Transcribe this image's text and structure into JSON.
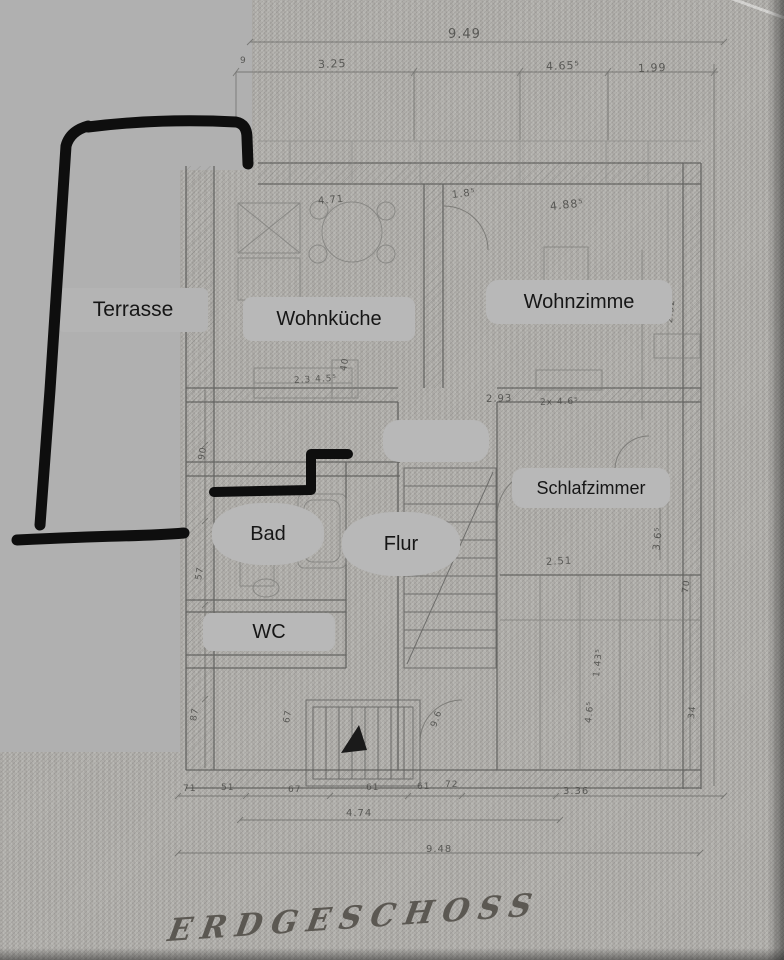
{
  "title": {
    "text": "ERDGESCHOSS"
  },
  "rooms": [
    {
      "id": "terrasse",
      "label": "Terrasse"
    },
    {
      "id": "wohnkueche",
      "label": "Wohnküche"
    },
    {
      "id": "wohnzimmer",
      "label": "Wohnzimme"
    },
    {
      "id": "schlafzimmer",
      "label": "Schlafzimmer"
    },
    {
      "id": "bad",
      "label": "Bad"
    },
    {
      "id": "flur",
      "label": "Flur"
    },
    {
      "id": "wc",
      "label": "WC"
    },
    {
      "id": "blank",
      "label": ""
    }
  ],
  "dimensions": {
    "total_width_top": "9.49",
    "total_width_bottom": "9.48",
    "top_segments": [
      "3.25",
      "4.65⁵",
      "1.99"
    ],
    "annotations": [
      {
        "text": "9.49",
        "x": 448,
        "y": 27,
        "rot": 0,
        "size": 13
      },
      {
        "text": "9",
        "x": 240,
        "y": 56,
        "rot": 0,
        "size": 9
      },
      {
        "text": "3.25",
        "x": 318,
        "y": 58,
        "rot": -2,
        "size": 11
      },
      {
        "text": "4.65⁵",
        "x": 546,
        "y": 60,
        "rot": -2,
        "size": 11
      },
      {
        "text": "1.99",
        "x": 638,
        "y": 62,
        "rot": -2,
        "size": 11
      },
      {
        "text": "4.71",
        "x": 318,
        "y": 196,
        "rot": -5,
        "size": 10
      },
      {
        "text": "1.8⁵",
        "x": 452,
        "y": 190,
        "rot": -7,
        "size": 10
      },
      {
        "text": "4.88⁵",
        "x": 550,
        "y": 200,
        "rot": -6,
        "size": 11
      },
      {
        "text": "2.3 4.5⁵",
        "x": 294,
        "y": 376,
        "rot": -3,
        "size": 9
      },
      {
        "text": "40",
        "x": 344,
        "y": 366,
        "rot": -80,
        "size": 9
      },
      {
        "text": "2.93",
        "x": 486,
        "y": 394,
        "rot": -2,
        "size": 10
      },
      {
        "text": "2x 4.6⁵",
        "x": 540,
        "y": 398,
        "rot": -2,
        "size": 9
      },
      {
        "text": "2.32⁵",
        "x": 384,
        "y": 565,
        "rot": -3,
        "size": 10
      },
      {
        "text": "2.51",
        "x": 546,
        "y": 557,
        "rot": -3,
        "size": 10
      },
      {
        "text": "2.52",
        "x": 670,
        "y": 318,
        "rot": -84,
        "size": 9
      },
      {
        "text": "3.6⁵",
        "x": 657,
        "y": 545,
        "rot": -84,
        "size": 10
      },
      {
        "text": "70",
        "x": 686,
        "y": 588,
        "rot": -84,
        "size": 9
      },
      {
        "text": "1.43⁵",
        "x": 597,
        "y": 672,
        "rot": -84,
        "size": 9
      },
      {
        "text": "4.6⁵",
        "x": 589,
        "y": 718,
        "rot": -84,
        "size": 9
      },
      {
        "text": "34",
        "x": 692,
        "y": 714,
        "rot": -84,
        "size": 9
      },
      {
        "text": "90",
        "x": 202,
        "y": 455,
        "rot": -80,
        "size": 9
      },
      {
        "text": "57",
        "x": 199,
        "y": 575,
        "rot": -80,
        "size": 9
      },
      {
        "text": "87",
        "x": 194,
        "y": 716,
        "rot": -80,
        "size": 9
      },
      {
        "text": "67",
        "x": 287,
        "y": 718,
        "rot": -80,
        "size": 9
      },
      {
        "text": "9.6",
        "x": 434,
        "y": 722,
        "rot": -70,
        "size": 9
      },
      {
        "text": "71",
        "x": 183,
        "y": 784,
        "rot": 0,
        "size": 9
      },
      {
        "text": "51",
        "x": 221,
        "y": 783,
        "rot": 0,
        "size": 9
      },
      {
        "text": "67",
        "x": 288,
        "y": 785,
        "rot": 0,
        "size": 9
      },
      {
        "text": "61",
        "x": 366,
        "y": 783,
        "rot": 0,
        "size": 9
      },
      {
        "text": "61",
        "x": 417,
        "y": 782,
        "rot": 0,
        "size": 9
      },
      {
        "text": "72",
        "x": 445,
        "y": 780,
        "rot": 0,
        "size": 9
      },
      {
        "text": "3.36",
        "x": 563,
        "y": 786,
        "rot": 0,
        "size": 10
      },
      {
        "text": "4.74",
        "x": 346,
        "y": 808,
        "rot": 0,
        "size": 10
      },
      {
        "text": "9.48",
        "x": 426,
        "y": 844,
        "rot": 0,
        "size": 10
      }
    ]
  },
  "colors": {
    "paper": "#b1afab",
    "flat_mask": "#b0b0b0",
    "label_chip": "#b8b8b8",
    "pencil_ink": "#5e5e5c",
    "marker": "#0e0e0e"
  }
}
